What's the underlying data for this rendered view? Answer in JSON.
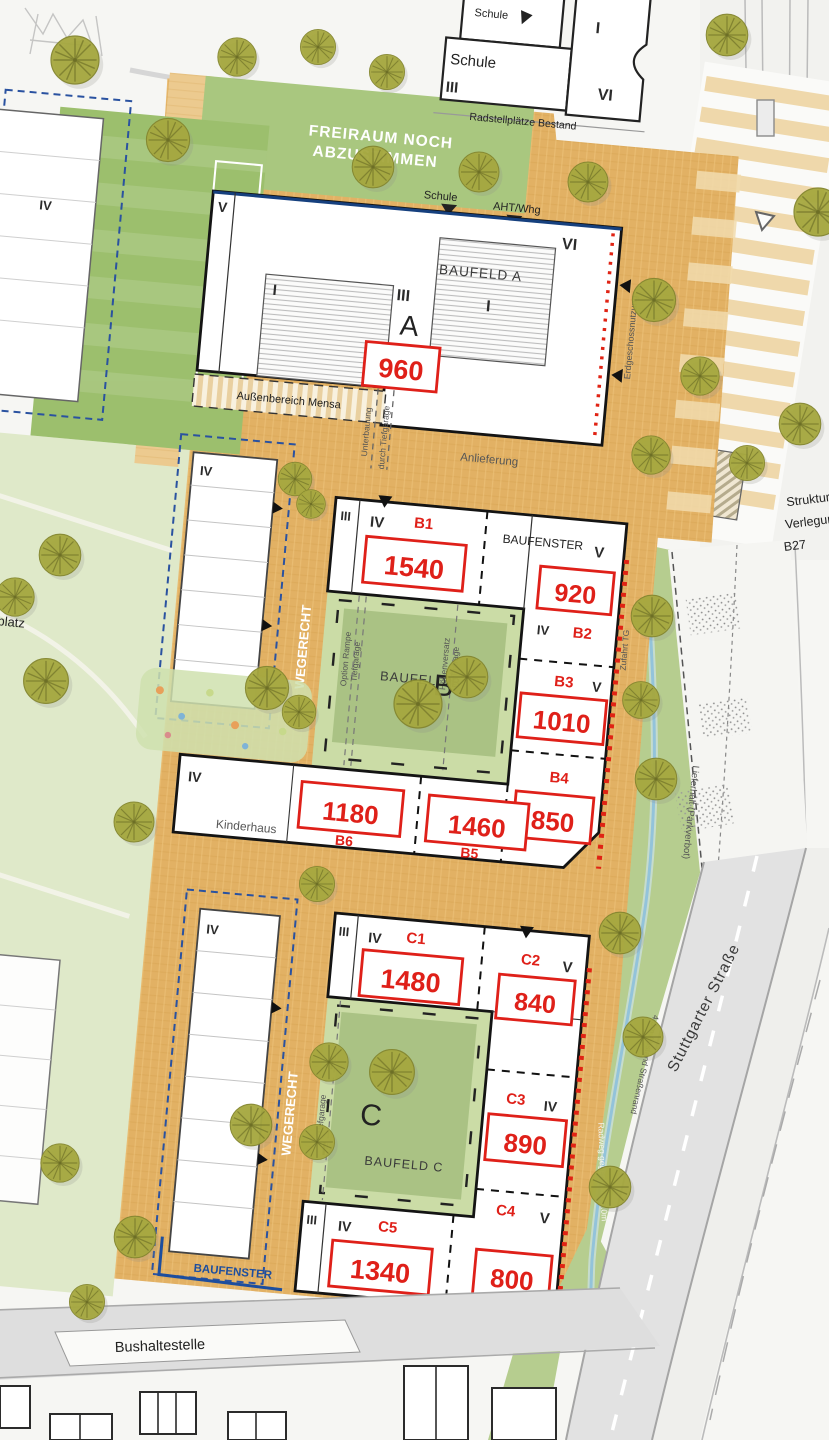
{
  "colors": {
    "red": "#df2019",
    "blue": "#1d4e9e",
    "ochre_plaza": "#e2b164",
    "green_lawn": "#a9c77f",
    "tree_olive": "#a6a83f",
    "street_gray": "#e2e2e2"
  },
  "floors": {
    "I": "I",
    "III": "III",
    "IV": "IV",
    "V": "V",
    "VI": "VI"
  },
  "top": {
    "schule_small": "Schule",
    "schule": "Schule",
    "radstellplaetze": "Radstellplätze Bestand",
    "freiraum1": "FREIRAUM NOCH",
    "freiraum2": "ABZUSTIMMEN",
    "wegerecht_bestand": "WEGERECHT BESTAND",
    "marker_schule": "Schule",
    "marker_aht": "AHT/Whg",
    "bushaltestelle": "Bushaltestelle"
  },
  "a": {
    "title": "BAUFELD A",
    "letter": "A",
    "value": "960",
    "mensa": "Außenbereich Mensa",
    "anlieferung": "Anlieferung",
    "erdgeschoss": "Erdgeschossnutzung",
    "unterbauung": "Unterbauung",
    "durch_tg": "durch Tiefgarage"
  },
  "b": {
    "title": "BAUFELD B",
    "letter": "B",
    "baufenster": "BAUFENSTER",
    "wegerecht": "WEGERECHT",
    "option_rampe": "Option Rampe",
    "tiefgarage": "Tiefgarage",
    "hoehenversatz": "Höhenversatz",
    "zufahrt_tg": "Zufahrt TG",
    "kinderhaus": "Kinderhaus",
    "b1": {
      "label": "B1",
      "value": "1540"
    },
    "b2": {
      "label": "B2",
      "value": "920"
    },
    "b3": {
      "label": "B3",
      "value": "1010"
    },
    "b4": {
      "label": "B4",
      "value": "850"
    },
    "b5": {
      "label": "B5",
      "value": "1460"
    },
    "b6": {
      "label": "B6",
      "value": "1180"
    }
  },
  "c": {
    "title": "BAUFELD C",
    "letter": "C",
    "wegerecht": "WEGERECHT",
    "tiefgarage": "Tiefgarage",
    "baufenster": "BAUFENSTER",
    "zufahrt_tg": "Zufahrt TG",
    "c1": {
      "label": "C1",
      "value": "1480"
    },
    "c2": {
      "label": "C2",
      "value": "840"
    },
    "c3": {
      "label": "C3",
      "value": "890"
    },
    "c4": {
      "label": "C4",
      "value": "800"
    },
    "c5": {
      "label": "C5",
      "value": "1340"
    }
  },
  "east": {
    "struktur": "Struktur",
    "verlegung": "Verlegung",
    "b27": "B27",
    "lieferhalt": "Lieferhalt (Parkverbot)",
    "strasse": "Stuttgarter Straße",
    "abstand": "4.5m Abstand Straßenrand",
    "radweg": "Radweg gegenläufig 3.0m"
  },
  "west": {
    "platz": "platz"
  },
  "south": {
    "bushaltestelle": "Bushaltestelle"
  }
}
